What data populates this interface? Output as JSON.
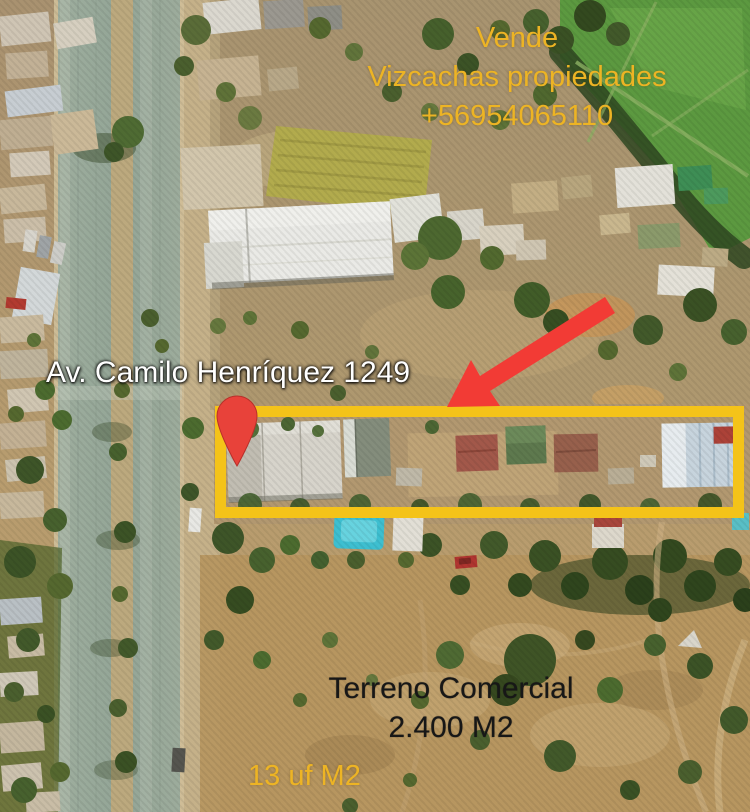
{
  "ad": {
    "banner": {
      "line1": "Vende",
      "line2": "Vizcachas propiedades",
      "line3": "+56954065110"
    },
    "address": "Av. Camilo Henríquez 1249",
    "listing": {
      "type": "Terreno Comercial",
      "area": "2.400 M2",
      "price_per_m2": "13 uf M2"
    }
  },
  "colors": {
    "accent_yellow": "#EDB424",
    "highlight_yellow": "#F4C319",
    "marker_red": "#E8423A",
    "arrow_red": "#F23B35",
    "text_black": "#171717",
    "text_white": "#FFFFFF"
  },
  "icons": {
    "map_pin": "map-pin-icon",
    "arrow": "arrow-icon"
  }
}
